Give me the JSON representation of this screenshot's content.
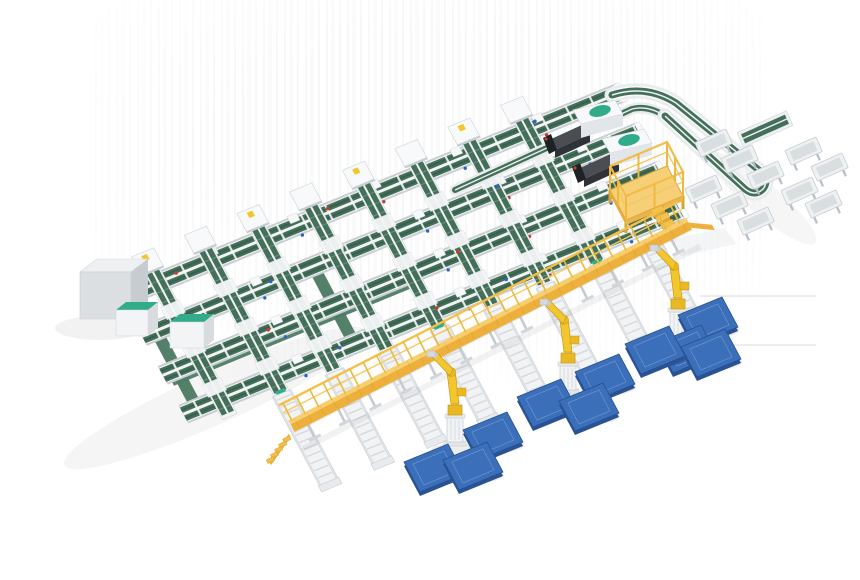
{
  "scene": {
    "description": "3D isometric render of an automated parcel sorting line with green belt conveyors, yellow elevated walkway, palletizing robots and blue pallets",
    "background": "#ffffff",
    "palette": {
      "frame_light": "#f1f3f4",
      "frame_mid": "#d3d8dc",
      "frame_dark": "#c7ccd1",
      "rail_gray": "#c9ced2",
      "belt_green": "#44705a",
      "belt_green_dark": "#38604c",
      "floor_green": "#4e7c65",
      "accent_teal": "#31ab89",
      "walkway_yellow": "#f3bf45",
      "walkway_yellow_dark": "#eeb03c",
      "walkway_edge": "#f8cf6e",
      "railing_yellow": "#edb93f",
      "platform_floor": "#f7cf76",
      "platform_rim": "#e2a93c",
      "robot_yellow": "#f4c62e",
      "robot_outline": "#c79a18",
      "pedestal_white": "#f1f3f5",
      "pallet_blue": "#3b6fba",
      "pallet_blue_dark": "#2a5394",
      "machine_dark": "#4a4e53",
      "machine_darker": "#2f3236",
      "cabinet_gray": "#dcdfe2",
      "tray_inner": "#d9dee1",
      "white": "#ffffff",
      "sensor_red": "#cc3b2e",
      "sensor_blue": "#2e62c8",
      "artifact_line": "#dcdedf",
      "shadow": "#000000"
    },
    "equipment": [
      {
        "name": "dual-belt-sorter-line",
        "count": 4
      },
      {
        "name": "induction-cross-conveyor",
        "count": 8
      },
      {
        "name": "discharge-roller-spur",
        "count": 8
      },
      {
        "name": "palletizing-robot",
        "count": 3
      },
      {
        "name": "pallet",
        "count": 10
      },
      {
        "name": "tray-station",
        "count": 10
      },
      {
        "name": "telescopic-loader",
        "count": 2
      },
      {
        "name": "maintenance-platform",
        "count": 1
      },
      {
        "name": "elevated-walkway",
        "count": 1
      },
      {
        "name": "control-cabinet",
        "count": 3
      },
      {
        "name": "return-loop-conveyor",
        "count": 1
      }
    ]
  }
}
